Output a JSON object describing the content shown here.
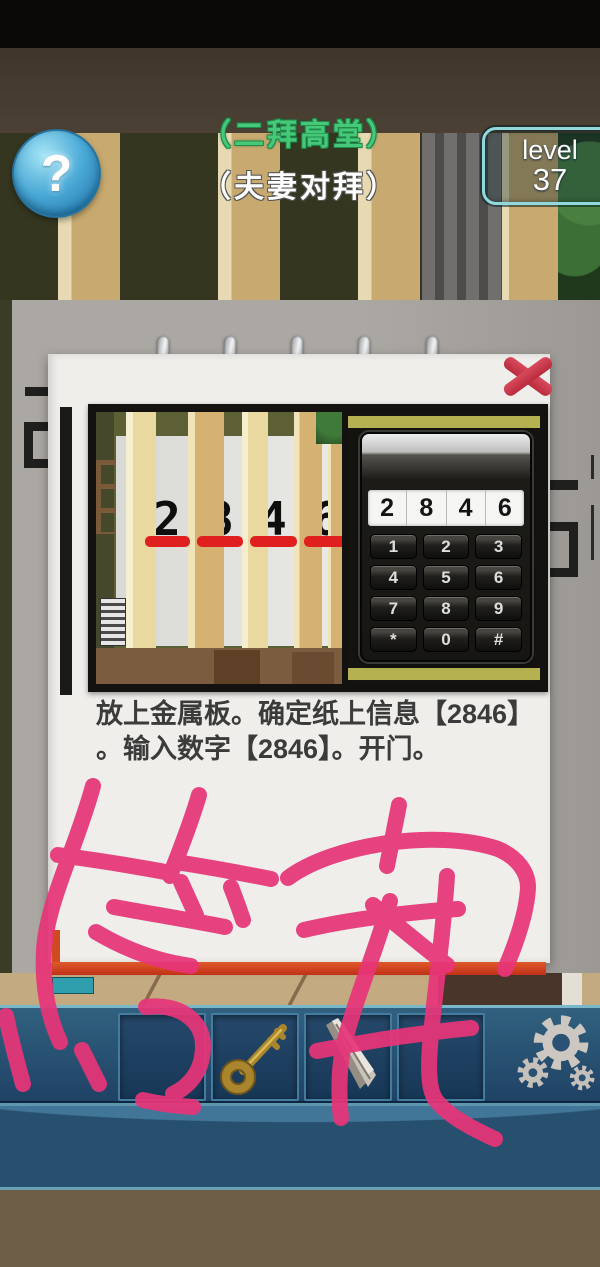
{
  "header": {
    "title_top": "（二拜高堂）",
    "title_bottom": "（夫妻对拜）",
    "help": "?",
    "level_label": "level",
    "level_value": "37"
  },
  "hint_panel": {
    "close": "X",
    "photo": {
      "paper_digits": [
        "2",
        "8",
        "4",
        "6"
      ],
      "keypad_display": [
        "2",
        "8",
        "4",
        "6"
      ],
      "keypad_keys": [
        "1",
        "2",
        "3",
        "4",
        "5",
        "6",
        "7",
        "8",
        "9",
        "*",
        "0",
        "#"
      ]
    },
    "hint_lines": [
      "放上金属板。确定纸上信息【2846】",
      "。输入数字【2846】。开门。"
    ]
  },
  "annotation": {
    "text": "答案",
    "color": "#e73579"
  },
  "inventory": {
    "items": [
      {
        "slot": 1,
        "name": "empty"
      },
      {
        "slot": 2,
        "name": "key"
      },
      {
        "slot": 3,
        "name": "metal-plate"
      },
      {
        "slot": 4,
        "name": "empty"
      }
    ],
    "settings_icon": "gear"
  },
  "colors": {
    "annotation_pink": "#e73579",
    "title_green": "#46c878",
    "level_border": "#8fd8dc",
    "underline_red": "#e01f1f",
    "inventory_blue": "#27506f",
    "paper_white": "#efeeea"
  }
}
